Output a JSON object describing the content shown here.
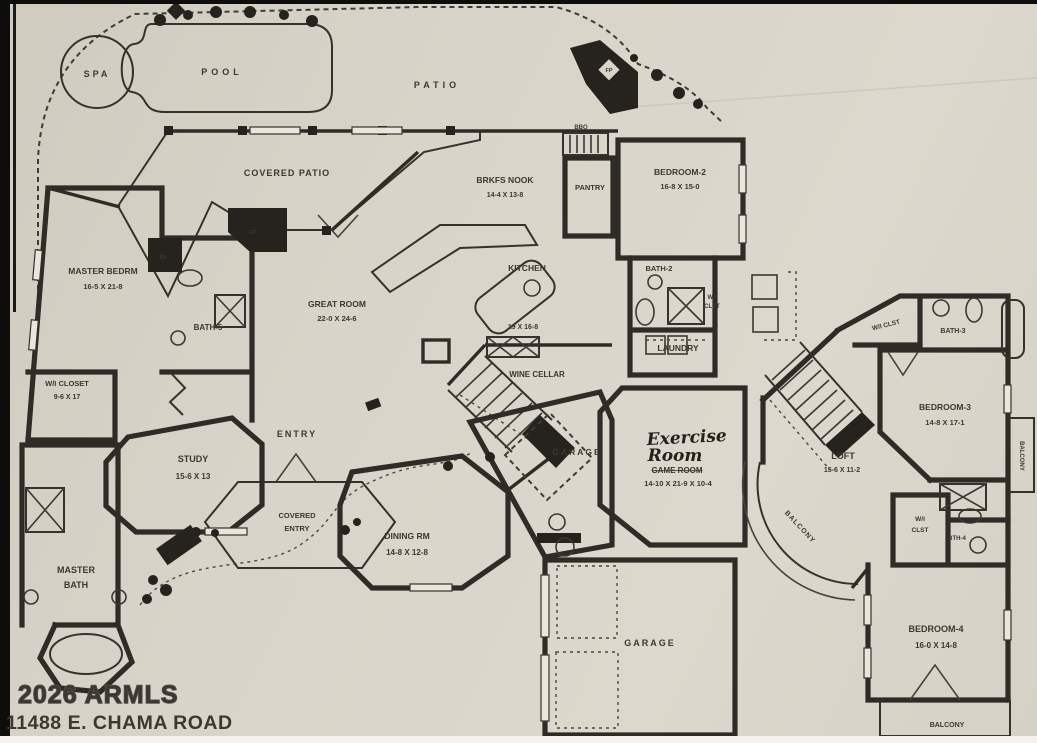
{
  "plan": {
    "watermark": "2026 ARMLS",
    "address": "11488 E. CHAMA ROAD"
  },
  "outdoor": {
    "spa": "SPA",
    "pool": "POOL",
    "patio": "PATIO",
    "covered_patio": "COVERED PATIO",
    "bbq": "BBQ"
  },
  "markers": {
    "fp": "FP"
  },
  "rooms": {
    "master_bedroom": {
      "name": "MASTER BEDRM",
      "dims": "16-5 X 21-8"
    },
    "bath5": {
      "name": "BATH-5"
    },
    "wi_closet_master": {
      "name": "W/I CLOSET",
      "dims": "9-6 X 17"
    },
    "master_bath": {
      "line1": "MASTER",
      "line2": "BATH"
    },
    "great_room": {
      "name": "GREAT ROOM",
      "dims": "22-0 X 24-6"
    },
    "brkfs_nook": {
      "name": "BRKFS NOOK",
      "dims": "14-4 X 13-8"
    },
    "kitchen": {
      "name": "KITCHEN",
      "dims": "19 X 16-8"
    },
    "pantry": {
      "name": "PANTRY"
    },
    "bedroom2": {
      "name": "BEDROOM-2",
      "dims": "16-8 X 15-0"
    },
    "bath2": {
      "name": "BATH-2"
    },
    "wi_clst_bed2": {
      "line1": "W/I",
      "line2": "CLST"
    },
    "laundry": {
      "name": "LAUNDRY"
    },
    "wine_cellar": {
      "name": "WINE CELLAR"
    },
    "entry": {
      "name": "ENTRY"
    },
    "covered_entry": {
      "line1": "COVERED",
      "line2": "ENTRY"
    },
    "study": {
      "name": "STUDY",
      "dims": "15-6 X 13"
    },
    "dining": {
      "name": "DINING RM",
      "dims": "14-8 X 12-8"
    },
    "garage_upper": {
      "name": "GARAGE"
    },
    "garage_lower": {
      "name": "GARAGE"
    },
    "exercise": {
      "hand1": "Exercise",
      "hand2": "Room",
      "struck": "GAME ROOM",
      "dims": "14-10 X 21-9 X 10-4"
    },
    "loft": {
      "name": "LOFT",
      "dims": "15-6 X 11-2"
    },
    "bedroom3": {
      "name": "BEDROOM-3",
      "dims": "14-8 X 17-1"
    },
    "bath3": {
      "name": "BATH-3"
    },
    "wi_clst_bed3": {
      "name": "W/I CLST"
    },
    "bedroom4": {
      "name": "BEDROOM-4",
      "dims": "16-0 X 14-8"
    },
    "bth4": {
      "name": "BTH-4"
    },
    "wi_clst_bed4": {
      "line1": "W/I",
      "line2": "CLST"
    },
    "balcony_loft": "BALCONY",
    "balcony_right": "BALCONY",
    "balcony_bottom": "BALCONY"
  }
}
